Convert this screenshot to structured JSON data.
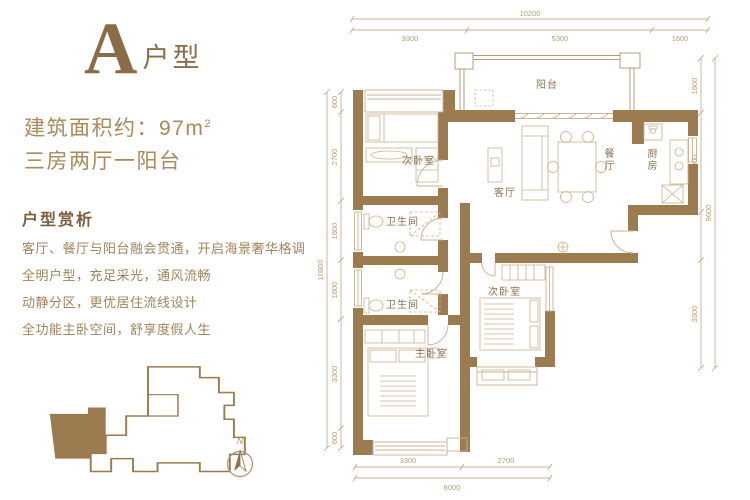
{
  "header": {
    "unit_letter": "A",
    "unit_type": "户型"
  },
  "summary": {
    "area_prefix": "建筑面积约：97m",
    "area_exponent": "2",
    "layout": "三房两厅一阳台"
  },
  "analysis": {
    "title": "户型赏析",
    "lines": [
      "客厅、餐厅与阳台融会贯通，开启海景奢华格调",
      "全明户型，充足采光，通风流畅",
      "动静分区，更优居住流线设计",
      "全功能主卧空间，舒享度假人生"
    ]
  },
  "rooms": {
    "balcony": "阳台",
    "bedroom_top": "次卧室",
    "living": "客厅",
    "dining": "餐厅",
    "kitchen": "厨房",
    "bath_upper": "卫生间",
    "bath_lower": "卫生间",
    "bedroom_mid": "次卧室",
    "master": "主卧室"
  },
  "dimensions": {
    "top": {
      "total": "10200",
      "segments": [
        "3300",
        "5300",
        "1600"
      ]
    },
    "bottom": {
      "total": "6000",
      "segments": [
        "3300",
        "2700"
      ]
    },
    "left": {
      "total": "10800",
      "segments": [
        "600",
        "2700",
        "1800",
        "1800",
        "3300",
        "600"
      ]
    },
    "right": {
      "total": "9600",
      "segments": [
        "1800",
        "3000",
        "3300"
      ]
    }
  },
  "compass": {
    "north": "N"
  },
  "colors": {
    "wall": "#9c7b51",
    "accent": "#8a6d47",
    "dim_line": "#b49c79",
    "furniture_line": "#c9b18e"
  }
}
